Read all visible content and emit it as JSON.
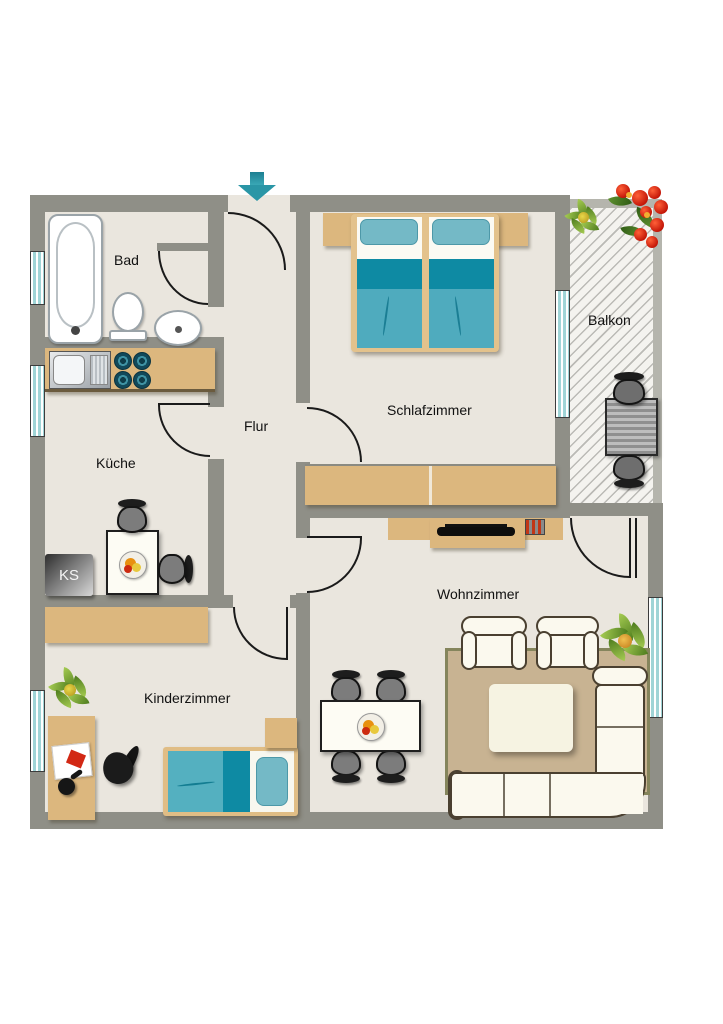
{
  "rooms": [
    {
      "name": "bathroom",
      "label": "Bad"
    },
    {
      "name": "kitchen",
      "label": "Küche"
    },
    {
      "name": "hallway",
      "label": "Flur"
    },
    {
      "name": "bedroom",
      "label": "Schlafzimmer"
    },
    {
      "name": "balcony",
      "label": "Balkon"
    },
    {
      "name": "living-room",
      "label": "Wohnzimmer"
    },
    {
      "name": "kids-room",
      "label": "Kinderzimmer"
    }
  ],
  "fridge": {
    "label": "KS"
  },
  "colors": {
    "wall": "#8f8f87",
    "floor": "#eae6de",
    "wood": "#dcb77e",
    "blanket_dark": "#0e8aa3",
    "blanket_light": "#4fabbe",
    "pillow": "#74b9c6",
    "window_glass": "#9fd4d6",
    "entrance_arrow": "#2a96a6",
    "upholstery": "#fbf9ee",
    "rug": "#c8b392"
  }
}
